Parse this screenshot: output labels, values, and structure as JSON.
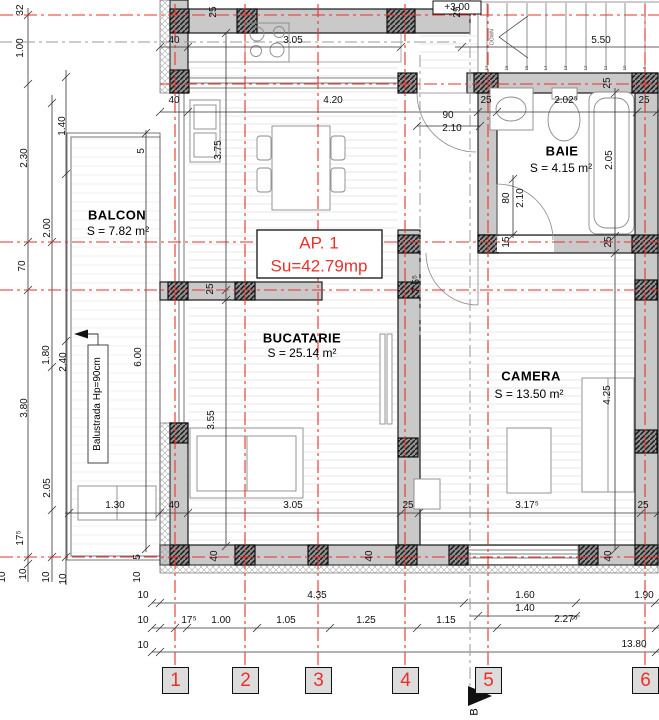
{
  "plan": {
    "apartment": {
      "label": "AP. 1",
      "area": "Su=42.79mp"
    },
    "level_marker": "+3.00",
    "rooms": {
      "balcon": {
        "name": "BALCON",
        "area": "S = 7.82 m²"
      },
      "bucatarie": {
        "name": "BUCATARIE",
        "area": "S = 25.14 m²"
      },
      "baie": {
        "name": "BAIE",
        "area": "S = 4.15 m²"
      },
      "camera": {
        "name": "CAMERA",
        "area": "S = 13.50 m²"
      }
    },
    "stairs": {
      "down_label": "DOWN",
      "steps": [
        "17",
        "16",
        "15",
        "14",
        "13",
        "12",
        "11",
        "10",
        "9"
      ]
    },
    "railing_note": "Balustrada Hp=90cm",
    "section_marker": "B",
    "grid_axes": [
      "1",
      "2",
      "3",
      "4",
      "5",
      "6"
    ],
    "colors": {
      "axis_red": "#e8312a",
      "wall_gray": "#c9c9c9",
      "column_hatch": "#8f8f8f"
    },
    "dimensions": {
      "horizontal": [
        "40",
        "3.05",
        "5.50",
        "40",
        "4.20",
        "25",
        "2.02⁵",
        "25",
        "90",
        "2.10",
        "1.30",
        "40",
        "3.05",
        "25",
        "3.17⁵",
        "25",
        "4.35",
        "1.60",
        "1.90",
        "1.40",
        "17⁵",
        "1.00",
        "1.05",
        "1.25",
        "1.15",
        "2.27⁵",
        "13.80",
        "10",
        "10",
        "10"
      ],
      "vertical": [
        "32",
        "1.00",
        "2.30",
        "70",
        "3.80",
        "17⁵",
        "10",
        "2.00",
        "1.80",
        "2.05",
        "10",
        "1.40",
        "2.40",
        "10",
        "10",
        "10",
        "25",
        "25",
        "25",
        "3.75",
        "5",
        "6.00",
        "3.55",
        "7.5⁵",
        "25",
        "15",
        "25",
        "2.05",
        "80",
        "2.10",
        "4.25",
        "40",
        "40",
        "40",
        "5"
      ]
    }
  }
}
